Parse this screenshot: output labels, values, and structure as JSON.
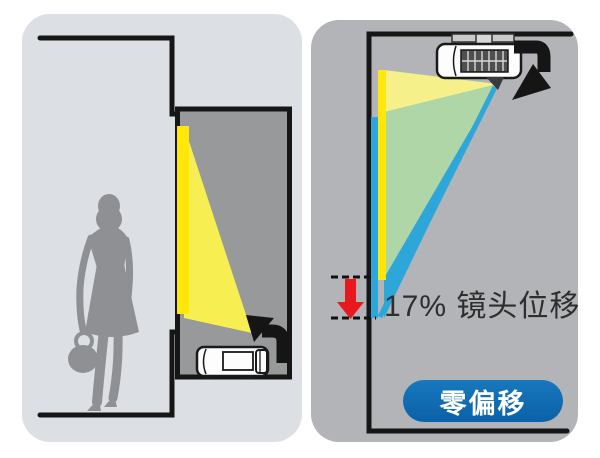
{
  "panels": {
    "right": {
      "shift_label": "17% 镜头位移",
      "badge_label": "零偏移"
    }
  },
  "colors": {
    "image_yellow": "#ffe70a",
    "beam_yellow": "#f7ee52",
    "beam_yellow_pale": "#f5f08a",
    "beam_blue": "#2da6da",
    "badge_blue": "#0d6cb3",
    "arrow_red": "#e8191d",
    "left_card_bg": "#dcdfe3",
    "right_card_bg": "#b2b4b7",
    "alcove_bg": "#97999b",
    "outline_black": "#161616",
    "silhouette_gray": "#8e9094"
  }
}
